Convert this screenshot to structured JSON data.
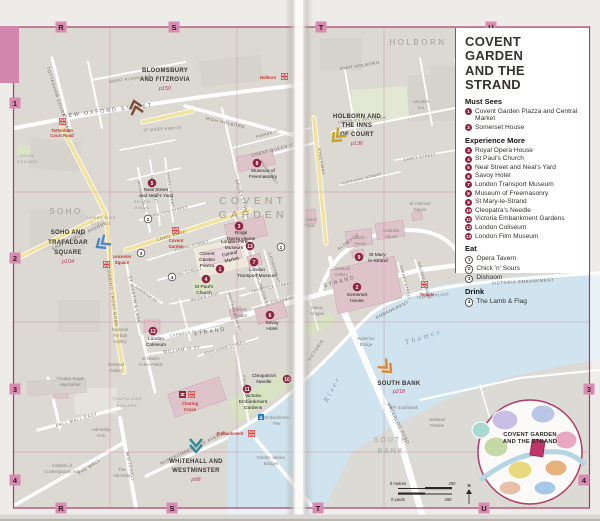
{
  "colors": {
    "border_pink": "#a83e68",
    "grid_label_bg": "#d88bb0",
    "thumb_tab": "#d286ad",
    "station_red": "#dc241f",
    "sight_marker": "#8e2342",
    "water": "#cfe4ee",
    "important_building": "#dfc3ca",
    "park_green": "#d8e3c2",
    "secondary_road": "#f2e2a0",
    "chevron_bloomsbury": "#7d4b35",
    "chevron_holborn": "#c9a227",
    "chevron_soho": "#4f86c6",
    "chevron_whitehall": "#2f8b99",
    "chevron_southbank": "#e0882f"
  },
  "grid": {
    "top": [
      "R",
      "S",
      "T",
      "U"
    ],
    "bottom": [
      "R",
      "S",
      "T",
      "U"
    ],
    "left": [
      "1",
      "2",
      "3",
      "4"
    ],
    "right": [
      "3",
      "4"
    ]
  },
  "legend": {
    "title_line1": "COVENT GARDEN",
    "title_line2": "AND THE STRAND",
    "sections": [
      {
        "heading": "Must Sees",
        "items": [
          {
            "n": "1",
            "label": "Covent Garden Piazza and Central Market"
          },
          {
            "n": "2",
            "label": "Somerset House"
          }
        ]
      },
      {
        "heading": "Experience More",
        "items": [
          {
            "n": "3",
            "label": "Royal Opera House"
          },
          {
            "n": "4",
            "label": "St Paul's Church"
          },
          {
            "n": "5",
            "label": "Neal Street and Neal's Yard"
          },
          {
            "n": "6",
            "label": "Savoy Hotel"
          },
          {
            "n": "7",
            "label": "London Transport Museum"
          },
          {
            "n": "8",
            "label": "Museum of Freemasonry"
          },
          {
            "n": "9",
            "label": "St Mary-le-Strand"
          },
          {
            "n": "10",
            "label": "Cleopatra's Needle"
          },
          {
            "n": "11",
            "label": "Victoria Embankment Gardens"
          },
          {
            "n": "12",
            "label": "London Coliseum"
          },
          {
            "n": "13",
            "label": "London Film Museum"
          }
        ]
      },
      {
        "heading": "Eat",
        "items": [
          {
            "n": "1",
            "label": "Opera Tavern"
          },
          {
            "n": "2",
            "label": "Chick 'n' Sours"
          },
          {
            "n": "3",
            "label": "Dishoom"
          }
        ]
      },
      {
        "heading": "Drink",
        "items": [
          {
            "n": "4",
            "label": "The Lamb & Flag"
          }
        ]
      }
    ]
  },
  "map": {
    "areas": {
      "holborn": "HOLBORN",
      "soho": "SOHO",
      "covent_l1": "COVENT",
      "covent_l2": "GARDEN",
      "south_l1": "SOUTH",
      "south_l2": "BANK",
      "traf_l1": "TRAFALGAR",
      "traf_l2": "SQUARE",
      "sohosq_l1": "SOHO",
      "sohosq_l2": "SQUARE",
      "camb_l1": "CAMBRIDGE",
      "camb_l2": "CIRCUS",
      "seven_l1": "SEVEN",
      "seven_l2": "DIALS"
    },
    "streets": {
      "new_oxford": "NEW OXFORD STREET",
      "great_russell": "GREAT RUSSELL ST",
      "tottenham": "TOTTENHAM COURT ROAD",
      "st_giles": "ST GILES HIGH ST",
      "high_holborn_l": "HIGH HOLBORN",
      "high_holborn_r": "HIGH HOLBORN",
      "shaftesbury": "SHAFTESBURY AVENUE",
      "charing_x": "CHARING CROSS ROAD",
      "monmouth": "MONMOUTH ST",
      "neal": "NEAL STREET",
      "endell": "ENDELL STREET",
      "shelton": "SHELTON STREET",
      "drury": "DRURY LANE",
      "great_queen": "GREAT QUEEN ST",
      "parker": "PARKER ST",
      "wild": "WILD STREET",
      "long_acre": "LONG ACRE",
      "floral": "FLORAL STREET",
      "king": "KING STREET",
      "maiden": "MAIDEN LANE",
      "bow": "BOW ST",
      "wellington": "WELLINGTON ST",
      "catherine": "CATHERINE ST",
      "tavistock": "TAVISTOCK STREET",
      "exeter": "EXETER ST",
      "southampton": "SOUTHAMPTON ST",
      "st_martins": "ST MARTIN'S LANE",
      "garrick": "GARRICK ST",
      "chandos": "CHANDOS PLACE",
      "william_iv": "WILLIAM IV ST",
      "strand_l": "STRAND",
      "strand_r": "STRAND",
      "john_adam": "JOHN ADAM STREET",
      "villiers": "VILLIERS ST",
      "northumberland": "NORTHUMBERLAND AVENUE",
      "whitehall": "WHITEHALL",
      "pall_mall": "PALL MALL EAST",
      "the_mall": "THE MALL",
      "kingsway": "KINGSWAY",
      "aldwych": "ALDWYCH",
      "lincolns_fields": "LINCOLN'S INN FIELDS",
      "portugal": "PORTUGAL STREET",
      "carey": "CAREY STREET",
      "arundel": "ARUNDEL STREET",
      "surrey": "SURREY STREET",
      "temple_pl": "TEMPLE PLACE",
      "victoria_r1": "VICTORIA",
      "embankment_r1": "EMBANKMENT",
      "victoria_embankment": "VICTORIA EMBANKMENT",
      "waterloo_rd": "WATERLOO ROAD",
      "wbridge_l1": "Waterloo",
      "wbridge_l2": "Bridge",
      "golden_l1": "Golden Jubilee",
      "golden_l2": "Bridges"
    },
    "pois": {
      "freemason_l1": "Museum of",
      "freemason_l2": "Freemasonry",
      "neal_l1": "Neal Street",
      "neal_l2": "and Neal's Yard",
      "roh_l1": "Royal",
      "roh_l2": "Opera House",
      "piazza_l1": "Covent",
      "piazza_l2": "Garden",
      "piazza_l3": "Piazza",
      "market_l1": "Central",
      "market_l2": "Market",
      "ltm_l1": "London",
      "ltm_l2": "Transport Museum",
      "film_l1": "London Film",
      "film_l2": "Museum",
      "stpaul_l1": "St Paul's",
      "stpaul_l2": "Church",
      "somerset_l1": "Somerset",
      "somerset_l2": "House",
      "stmary_l1": "St Mary-",
      "stmary_l2": "le-Strand",
      "courtauld_l1": "Courtauld",
      "courtauld_l2": "Gallery",
      "bush_l1": "Bush",
      "bush_l2": "House",
      "australia_l1": "Australia",
      "australia_l2": "House",
      "theatre_royal_l1": "Theatre",
      "theatre_royal_l2": "Royal",
      "stclement_l1": "St Clement",
      "stclement_l2": "Danes",
      "lincolns_inn_l1": "Lincoln's",
      "lincolns_inn_l2": "Inn",
      "savoy_l1": "Savoy",
      "savoy_l2": "Hotel",
      "savoy_chapel_l1": "Savoy",
      "savoy_chapel_l2": "Chapel",
      "adelphi_l1": "Adelphi",
      "adelphi_l2": "Theatre",
      "coliseum_l1": "London",
      "coliseum_l2": "Coliseum",
      "cleopatra_l1": "Cleopatra's",
      "cleopatra_l2": "Needle",
      "veg_l1": "Victoria",
      "veg_l2": "Embankment",
      "veg_l3": "Gardens",
      "npg_l1": "National",
      "npg_l2": "Portrait",
      "npg_l3": "Gallery",
      "ng_l1": "National",
      "ng_l2": "Gallery",
      "stmartin_l1": "St Martin-",
      "stmartin_l2": "in-the-Fields",
      "haymarket_l1": "Theatre Royal",
      "haymarket_l2": "Haymarket",
      "admarch_l1": "Admiralty",
      "admarch_l2": "Arch",
      "admiralty_l1": "The",
      "admiralty_l2": "Admiralty",
      "ica_l1": "Institute of",
      "ica_l2": "Contemporary Arts",
      "bfi": "BFI Southbank",
      "nt_l1": "National",
      "nt_l2": "Theatre",
      "pier_l1": "Embankment",
      "pier_l2": "Pier"
    },
    "stations": {
      "holborn": "Holborn",
      "tcr_l1": "Tottenham",
      "tcr_l2": "Court Road",
      "cg_l1": "Covent",
      "cg_l2": "Garden",
      "lsq_l1": "Leicester",
      "lsq_l2": "Square",
      "cc_l1": "Charing",
      "cc_l2": "Cross",
      "embankment": "Embankment",
      "temple": "Temple"
    },
    "markers": {
      "m1": "1",
      "m2": "2",
      "m3": "3",
      "m4": "4",
      "m5": "5",
      "m6": "6",
      "m7": "7",
      "m8": "8",
      "m9": "9",
      "m10": "10",
      "m11": "11",
      "m12": "12",
      "m13": "13",
      "e1": "1",
      "e2": "2",
      "e3": "3",
      "d4": "4"
    },
    "nav": {
      "bloomsbury": {
        "l1": "BLOOMSBURY",
        "l2": "AND FITZROVIA",
        "page": "p150"
      },
      "holborn": {
        "l1": "HOLBORN AND",
        "l2": "THE INNS",
        "l3": "OF COURT",
        "page": "p136"
      },
      "soho": {
        "l1": "SOHO AND",
        "l2": "TRAFALGAR",
        "l3": "SQUARE",
        "page": "p104"
      },
      "whitehall": {
        "l1": "WHITEHALL AND",
        "l2": "WESTMINSTER",
        "page": "p68"
      },
      "southbank": {
        "l1": "SOUTH BANK",
        "page": "p218"
      }
    },
    "river": {
      "l1": "River",
      "l2": "Thames"
    },
    "scale": {
      "m0": "0 metres",
      "m200": "200",
      "y0": "0 yards",
      "y200": "200",
      "n": "N"
    },
    "inset": {
      "l1": "COVENT GARDEN",
      "l2": "AND THE STRAND"
    }
  }
}
